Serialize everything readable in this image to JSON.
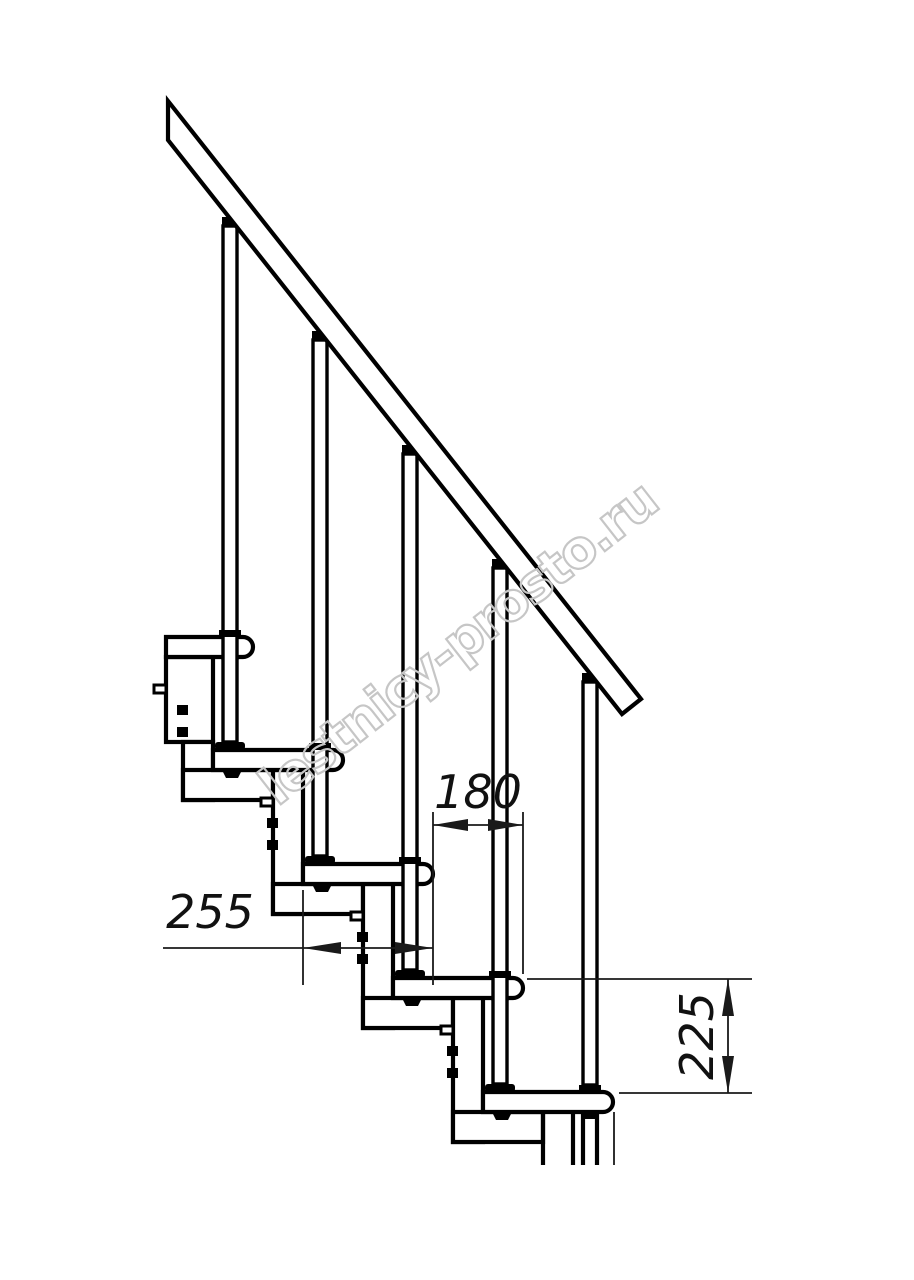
{
  "drawing": {
    "kind": "staircase-side-elevation",
    "dimensions": {
      "tread_depth": "255",
      "going": "180",
      "rise": "225"
    },
    "watermark": {
      "text": "lestnicy-prosto.ru",
      "color": "#c6c6c6"
    },
    "colors": {
      "line": "#000000",
      "thin_line": "#1a1a1a",
      "background": "#ffffff"
    }
  }
}
